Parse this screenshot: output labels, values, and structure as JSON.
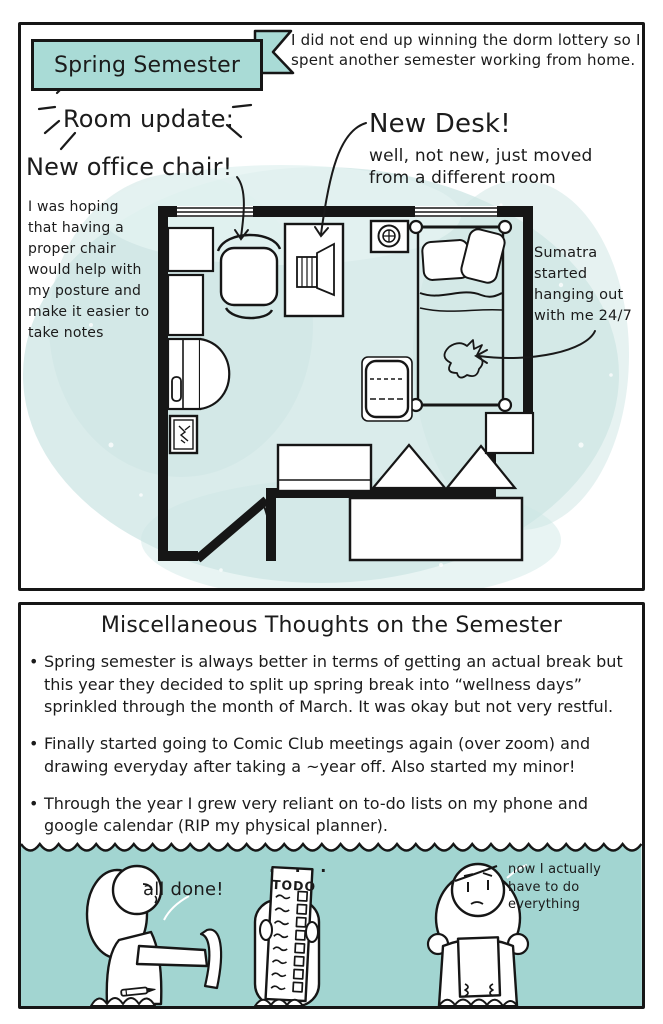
{
  "colors": {
    "teal_banner": "#a9dbd6",
    "teal_band": "#a2d5d1",
    "watercolor": "#d9eceb",
    "ink": "#161616"
  },
  "top_panel": {
    "banner": "Spring Semester",
    "intro": "I did not end up winning the dorm lottery so I spent another semester working from home.",
    "room_update": "Room update:",
    "new_chair": "New office chair!",
    "chair_note": "I was hoping that having a proper chair would help with my posture and make it easier to take notes",
    "new_desk": "New Desk!",
    "new_desk_sub": "well, not new, just moved from a different room",
    "sumatra_note": "Sumatra started hanging out with me 24/7"
  },
  "bottom_panel": {
    "title": "Miscellaneous Thoughts on the Semester",
    "bullet_char": "•",
    "bullets": [
      "Spring semester is always better in terms of getting an actual break but this year they decided to split up spring break into “wellness days” sprinkled through the month of March. It was okay but not very restful.",
      "Finally started going to Comic Club meetings again (over zoom) and drawing everyday after taking a ~year off. Also started my minor!",
      "Through the year I grew very reliant on to-do lists on my phone and google calendar (RIP my physical planner)."
    ],
    "comic": {
      "left_speech": "all done!",
      "dots": ". . .",
      "todo_title": "TODO",
      "right_speech": "now I actually have to do everything"
    }
  }
}
